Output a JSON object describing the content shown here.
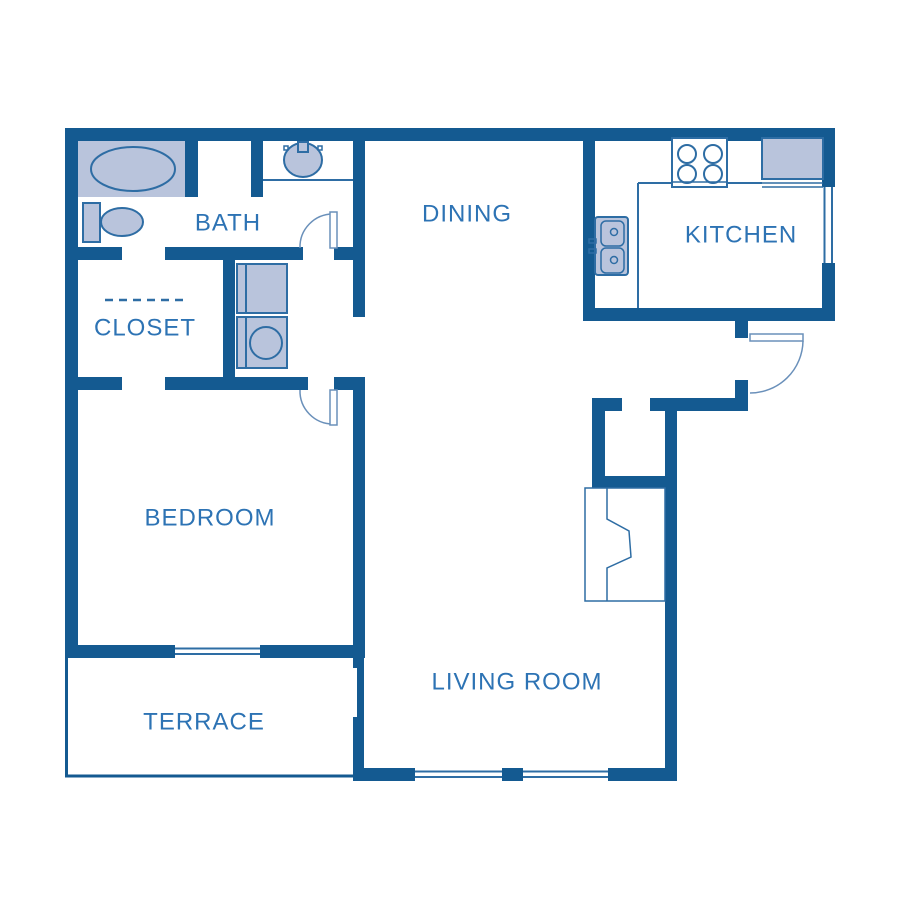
{
  "plan": {
    "title": "One-bedroom apartment floor plan",
    "rooms": [
      {
        "id": "bath",
        "label": "BATH"
      },
      {
        "id": "closet",
        "label": "CLOSET"
      },
      {
        "id": "dining",
        "label": "DINING"
      },
      {
        "id": "kitchen",
        "label": "KITCHEN"
      },
      {
        "id": "bedroom",
        "label": "BEDROOM"
      },
      {
        "id": "terrace",
        "label": "TERRACE"
      },
      {
        "id": "living-room",
        "label": "LIVING ROOM"
      }
    ],
    "fixtures": [
      "bathtub",
      "toilet",
      "bathroom-sink-vanity",
      "stacked-washer-dryer",
      "closet-rod-dashed-line",
      "kitchen-sink-double-basin",
      "stove-4-burner",
      "refrigerator",
      "kitchen-counter",
      "entry-coat-closet",
      "fireplace",
      "bath-door",
      "bedroom-door",
      "entry-door",
      "kitchen-window",
      "bedroom-terrace-window",
      "living-room-window-1",
      "living-room-window-2"
    ],
    "colors": {
      "wall": "#145a91",
      "fixture_fill": "#b9c4dc",
      "line": "#2e6da4",
      "arc": "#6a90ba",
      "label_text": "#2d73b4",
      "background": "#ffffff"
    }
  }
}
